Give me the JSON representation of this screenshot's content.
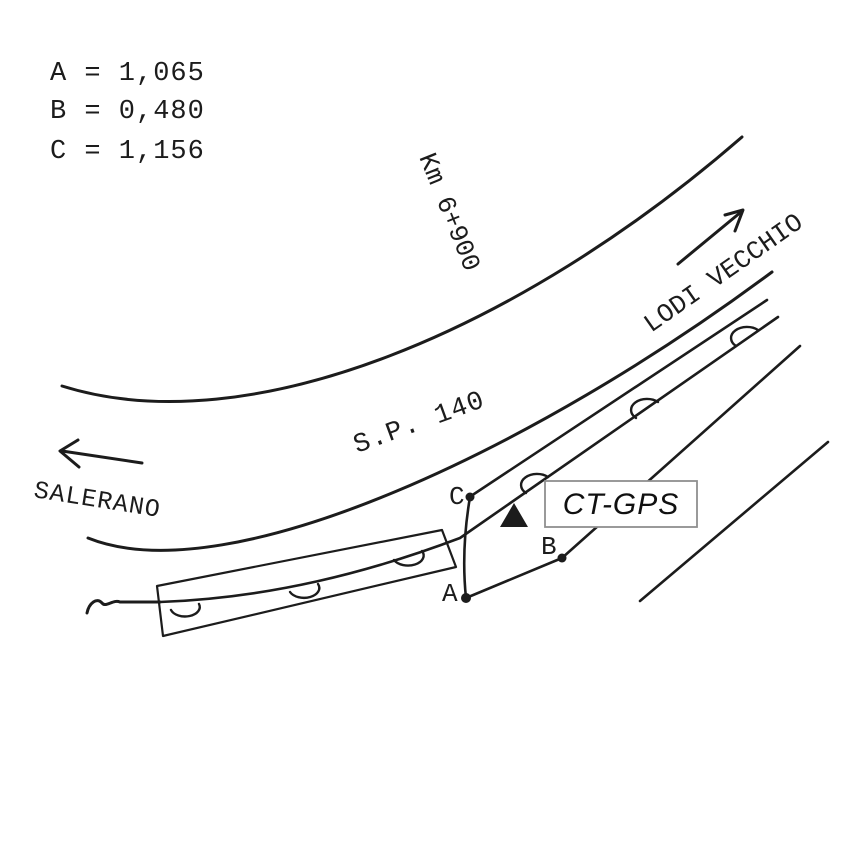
{
  "legend": {
    "items": [
      "A = 1,065",
      "B = 0,480",
      "C = 1,156"
    ]
  },
  "road": {
    "name": "S.P. 140",
    "km_marker": "Km 6+900",
    "destination_left": "SALERANO",
    "destination_right": "LODI VECCHIO"
  },
  "station": {
    "label": "CT-GPS",
    "marker": "filled-triangle"
  },
  "points": {
    "a": "A",
    "b": "B",
    "c": "C"
  },
  "colors": {
    "ink": "#1c1c1c",
    "box_border": "#8f8f8f",
    "background": "#ffffff"
  }
}
